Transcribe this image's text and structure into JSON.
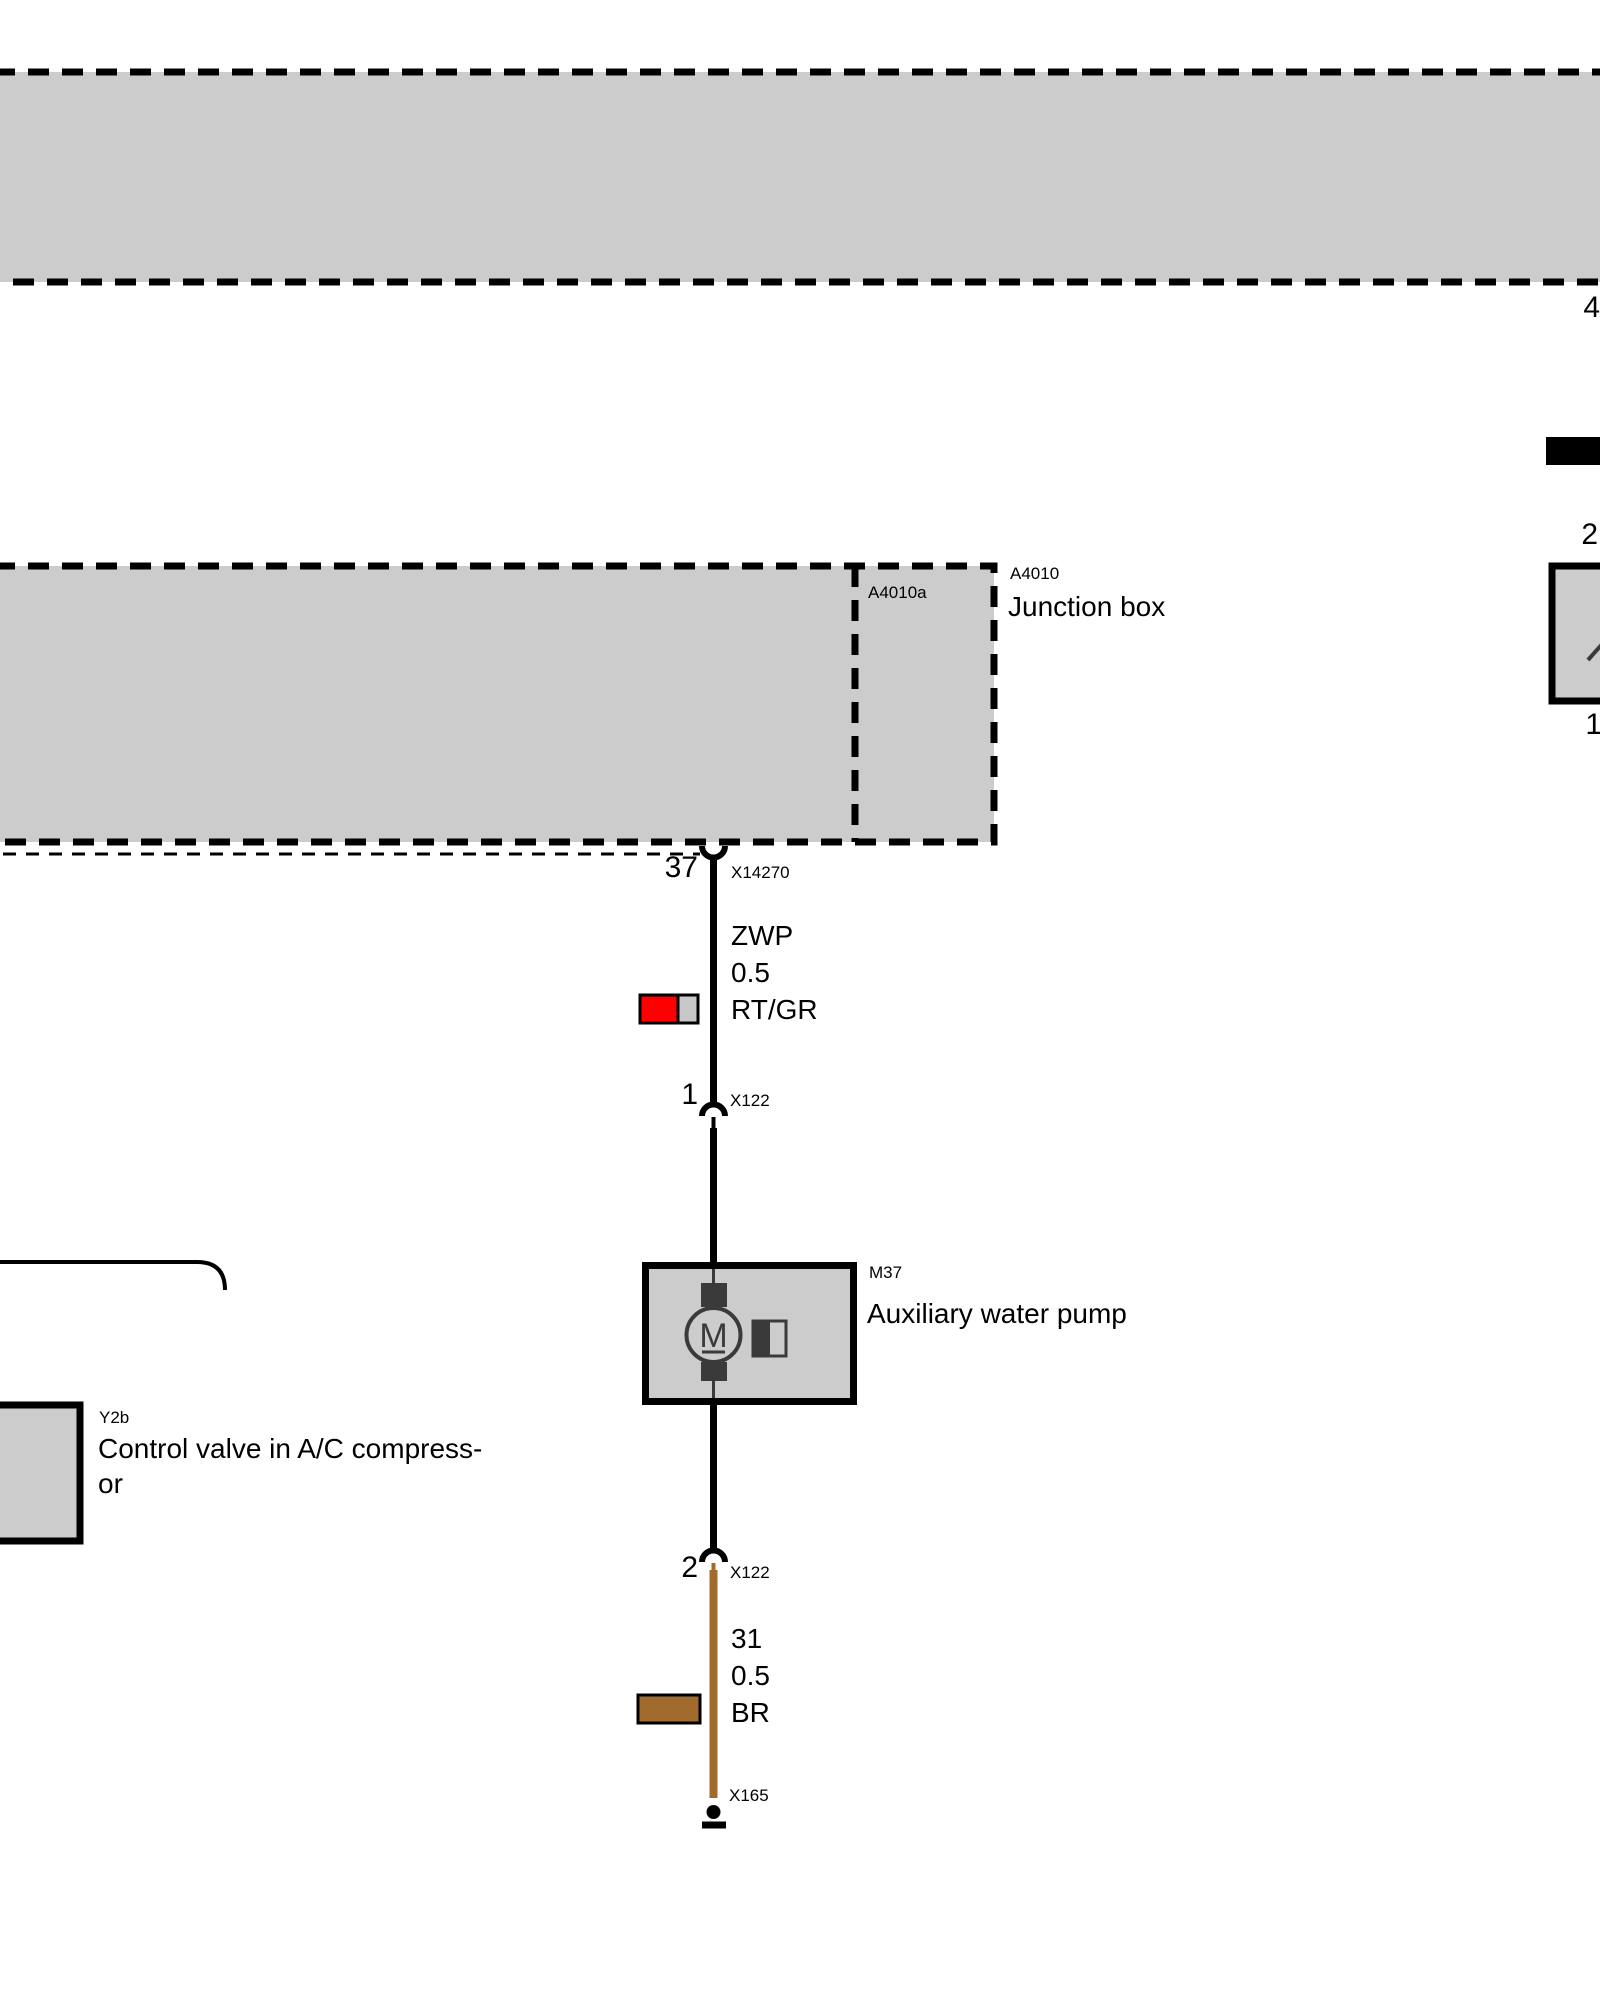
{
  "colors": {
    "module_fill": "#cccccc",
    "border_black": "#000000",
    "wire_black": "#000000",
    "wire_brown": "#a26b2e",
    "indicator_red": "#ff0000",
    "indicator_gray": "#c8c8c8",
    "symbol_dark": "#3a3a3a"
  },
  "top_module": {
    "pin": "4"
  },
  "junction_box": {
    "code": "A4010",
    "name": "Junction box",
    "sub_code": "A4010a",
    "connector_pin": "37",
    "connector_code": "X14270"
  },
  "power_wire": {
    "circuit": "ZWP",
    "cross_section": "0.5",
    "color_code": "RT/GR"
  },
  "connector_upper": {
    "pin": "1",
    "code": "X122"
  },
  "pump": {
    "code": "M37",
    "name": "Auxiliary water pump",
    "motor_letter": "M"
  },
  "connector_lower": {
    "pin": "2",
    "code": "X122"
  },
  "ground_wire": {
    "circuit": "31",
    "cross_section": "0.5",
    "color_code": "BR"
  },
  "ground_point": {
    "code": "X165"
  },
  "right_component": {
    "pin_top": "2",
    "pin_bottom": "1"
  },
  "control_valve": {
    "code": "Y2b",
    "name_line1": "Control valve in A/C compress-",
    "name_line2": "or"
  },
  "left_edge": {
    "clipped_pin": "6"
  }
}
